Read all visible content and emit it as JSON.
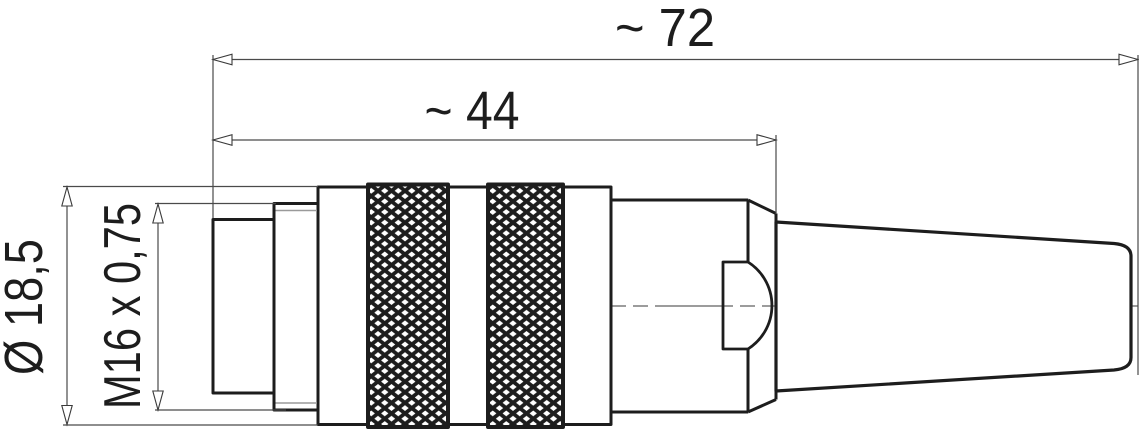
{
  "dimensions": {
    "overall_length": "~ 72",
    "front_length": "~ 44",
    "diameter": "Ø 18,5",
    "thread": "M16 x 0,75"
  },
  "colors": {
    "outline": "#1d1d1d",
    "dimension_line": "#4a4a4a",
    "arrow_fill": "#ffffff",
    "centerline": "#8f8f8f",
    "chamfer_line": "#9a9a9a",
    "background": "#ffffff"
  }
}
